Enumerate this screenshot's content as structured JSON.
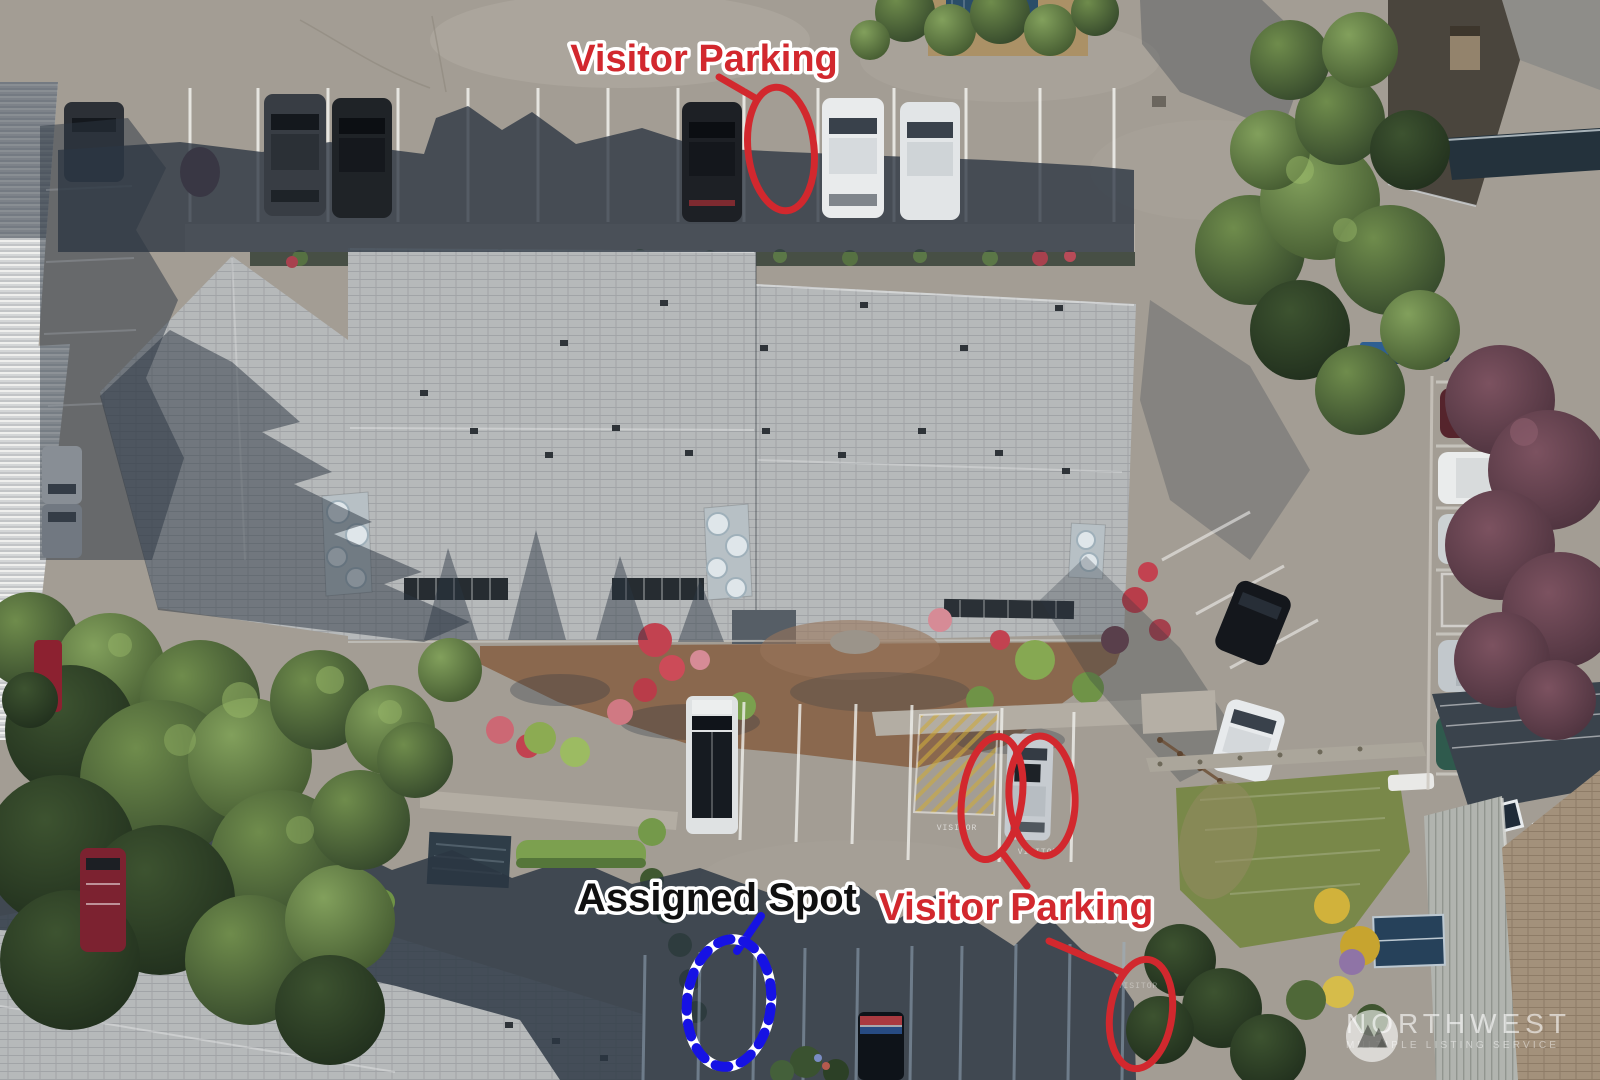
{
  "annotations": {
    "red": "#d2282e",
    "blue": "#1612e4",
    "dark": "#101010",
    "visitor_parking_top": "Visitor Parking",
    "visitor_parking_bottom": "Visitor Parking",
    "assigned_spot": "Assigned Spot"
  },
  "stencils": {
    "visitor": "VISITOR"
  },
  "watermark": {
    "brand": "NORTHWEST",
    "tagline": "MULTIPLE LISTING SERVICE"
  }
}
